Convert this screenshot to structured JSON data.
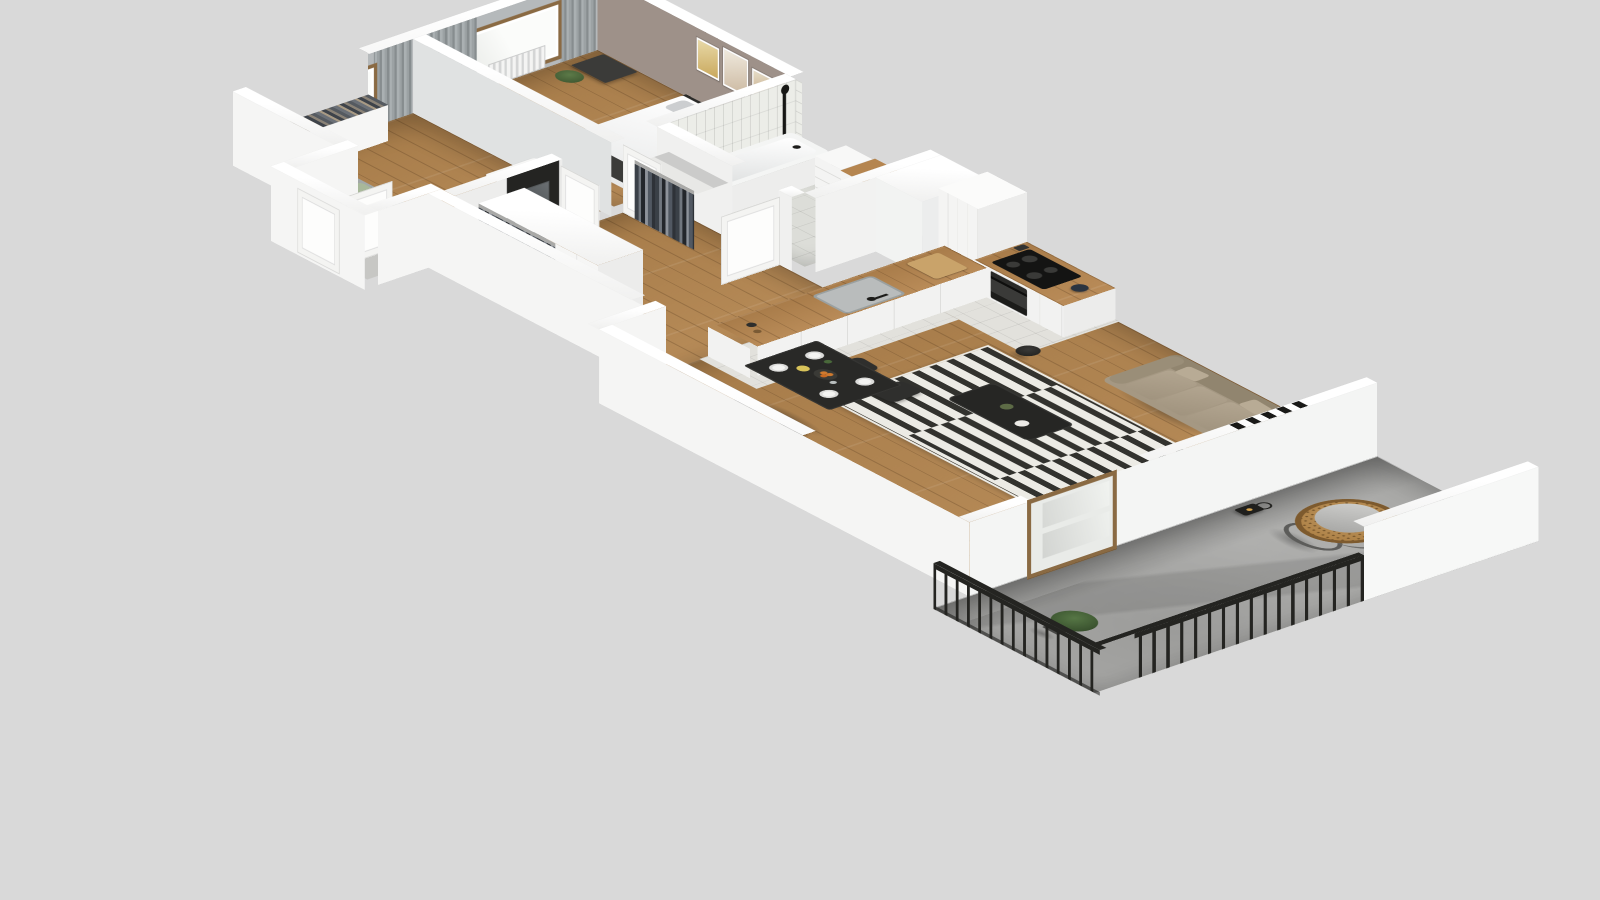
{
  "scene": {
    "type": "3d-floorplan-render",
    "style": "dollhouse cutaway isometric view of a one-bedroom apartment with balcony",
    "camera": "elevated oblique top-down, rotated clockwise",
    "no_visible_text": true
  },
  "palette": {
    "background": "#d9d9d9",
    "wall_top": "#ffffff",
    "wall_exterior": "#f5f5f4",
    "wall_interior": "#eef0f0",
    "room_wall_gray": "#b5b9bb",
    "accent_wall_taupe": "#9e9189",
    "accent_wall_black": "#242422",
    "floor_wood": "#b3854f",
    "counter_wood": "#b5854f",
    "floor_tile": "#e2e1dc",
    "bath_tile": "#ecede8",
    "rug_dark": "#32322e",
    "rug_light": "#ecebe5",
    "sofa_taupe": "#a59883",
    "curtain_gray": "#9aa0a2",
    "window_frame_wood": "#8a6a43",
    "appliance_black": "#1e1e1c",
    "concrete": "#a8a8a6",
    "railing_black": "#242421",
    "rattan": "#b08449",
    "cushion_gray": "#c5c5c3",
    "plant_green": "#4e6b3d",
    "pillow_pink": "#c5a8a6",
    "pillow_green": "#a8b89a"
  },
  "rooms": {
    "bedroom": {
      "name": "Bedroom",
      "floor": "wood planks",
      "furniture": [
        "double bed with white duvet",
        "two gray pillows",
        "dark throw runner",
        "black headboard",
        "dark dresser",
        "potted plant",
        "three framed prints on taupe accent wall",
        "window with gray curtains",
        "radiator"
      ]
    },
    "kids_room": {
      "name": "Second room / study",
      "floor": "wood planks",
      "furniture": [
        "daybed with pink and green pillows",
        "white desk",
        "round stool",
        "low bookshelf with books",
        "black cabinet",
        "potted plant",
        "window with gray curtains",
        "radiator"
      ]
    },
    "bathroom": {
      "name": "Bathroom",
      "floor": "light gray tile",
      "furniture": [
        "bathtub with black shower fixture",
        "vanity with wood top and white basin",
        "mirror",
        "two black wall sconces",
        "drawer unit",
        "white subway tile walls"
      ]
    },
    "hallway": {
      "name": "Hall / entry",
      "floor": "wood planks",
      "furniture": [
        "open wardrobe with hanging clothes",
        "white cabinet doors",
        "black accent niche with console and mirror",
        "open white interior doors",
        "recessed entrance with front door",
        "open clothes rail niche"
      ]
    },
    "kitchen": {
      "name": "Kitchen",
      "floor": "light tile",
      "furniture": [
        "tall white cabinets",
        "wood hood panel",
        "black cooktop with four burners",
        "built-in oven",
        "kettle",
        "utensil crock",
        "L-shaped counter with sink and faucet",
        "cutting board",
        "ventilation shaft column"
      ]
    },
    "living_room": {
      "name": "Living / dining room",
      "floor": "wood planks",
      "furniture": [
        "three-seat taupe sofa",
        "six framed prints gallery wall",
        "black and white striped rug",
        "black coffee table with vase and bowl",
        "black floor lamp",
        "TV unit",
        "glass vase",
        "potted plant",
        "black dining table set with plates and fruit bowl",
        "four black dining chairs",
        "radiator",
        "black ladder decor on wall top",
        "wood-framed balcony door"
      ]
    },
    "balcony": {
      "name": "Balcony",
      "floor": "concrete",
      "furniture": [
        "hanging egg chair with rattan shell and gray cushion",
        "black candle lantern",
        "potted green plant",
        "black metal railing with vertical balusters"
      ]
    }
  }
}
